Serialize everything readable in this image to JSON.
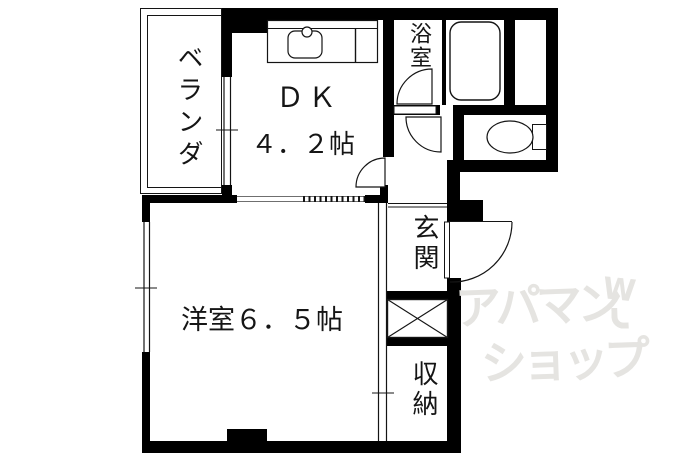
{
  "colors": {
    "wall": "#000000",
    "line": "#141414",
    "track": "#6f6f6f",
    "watermark": "#e5e4e1",
    "background": "#ffffff"
  },
  "rooms": {
    "veranda": {
      "label": "ベランダ"
    },
    "dk": {
      "name": "ＤＫ",
      "size": "４．２帖"
    },
    "bathroom": {
      "label": "浴室"
    },
    "western": {
      "label": "洋室６．５帖"
    },
    "entrance": {
      "label": "玄関"
    },
    "storage": {
      "label": "収納"
    }
  },
  "watermark": {
    "line1": "アパマン",
    "line2": "ショップ",
    "logo_letter": "W"
  }
}
